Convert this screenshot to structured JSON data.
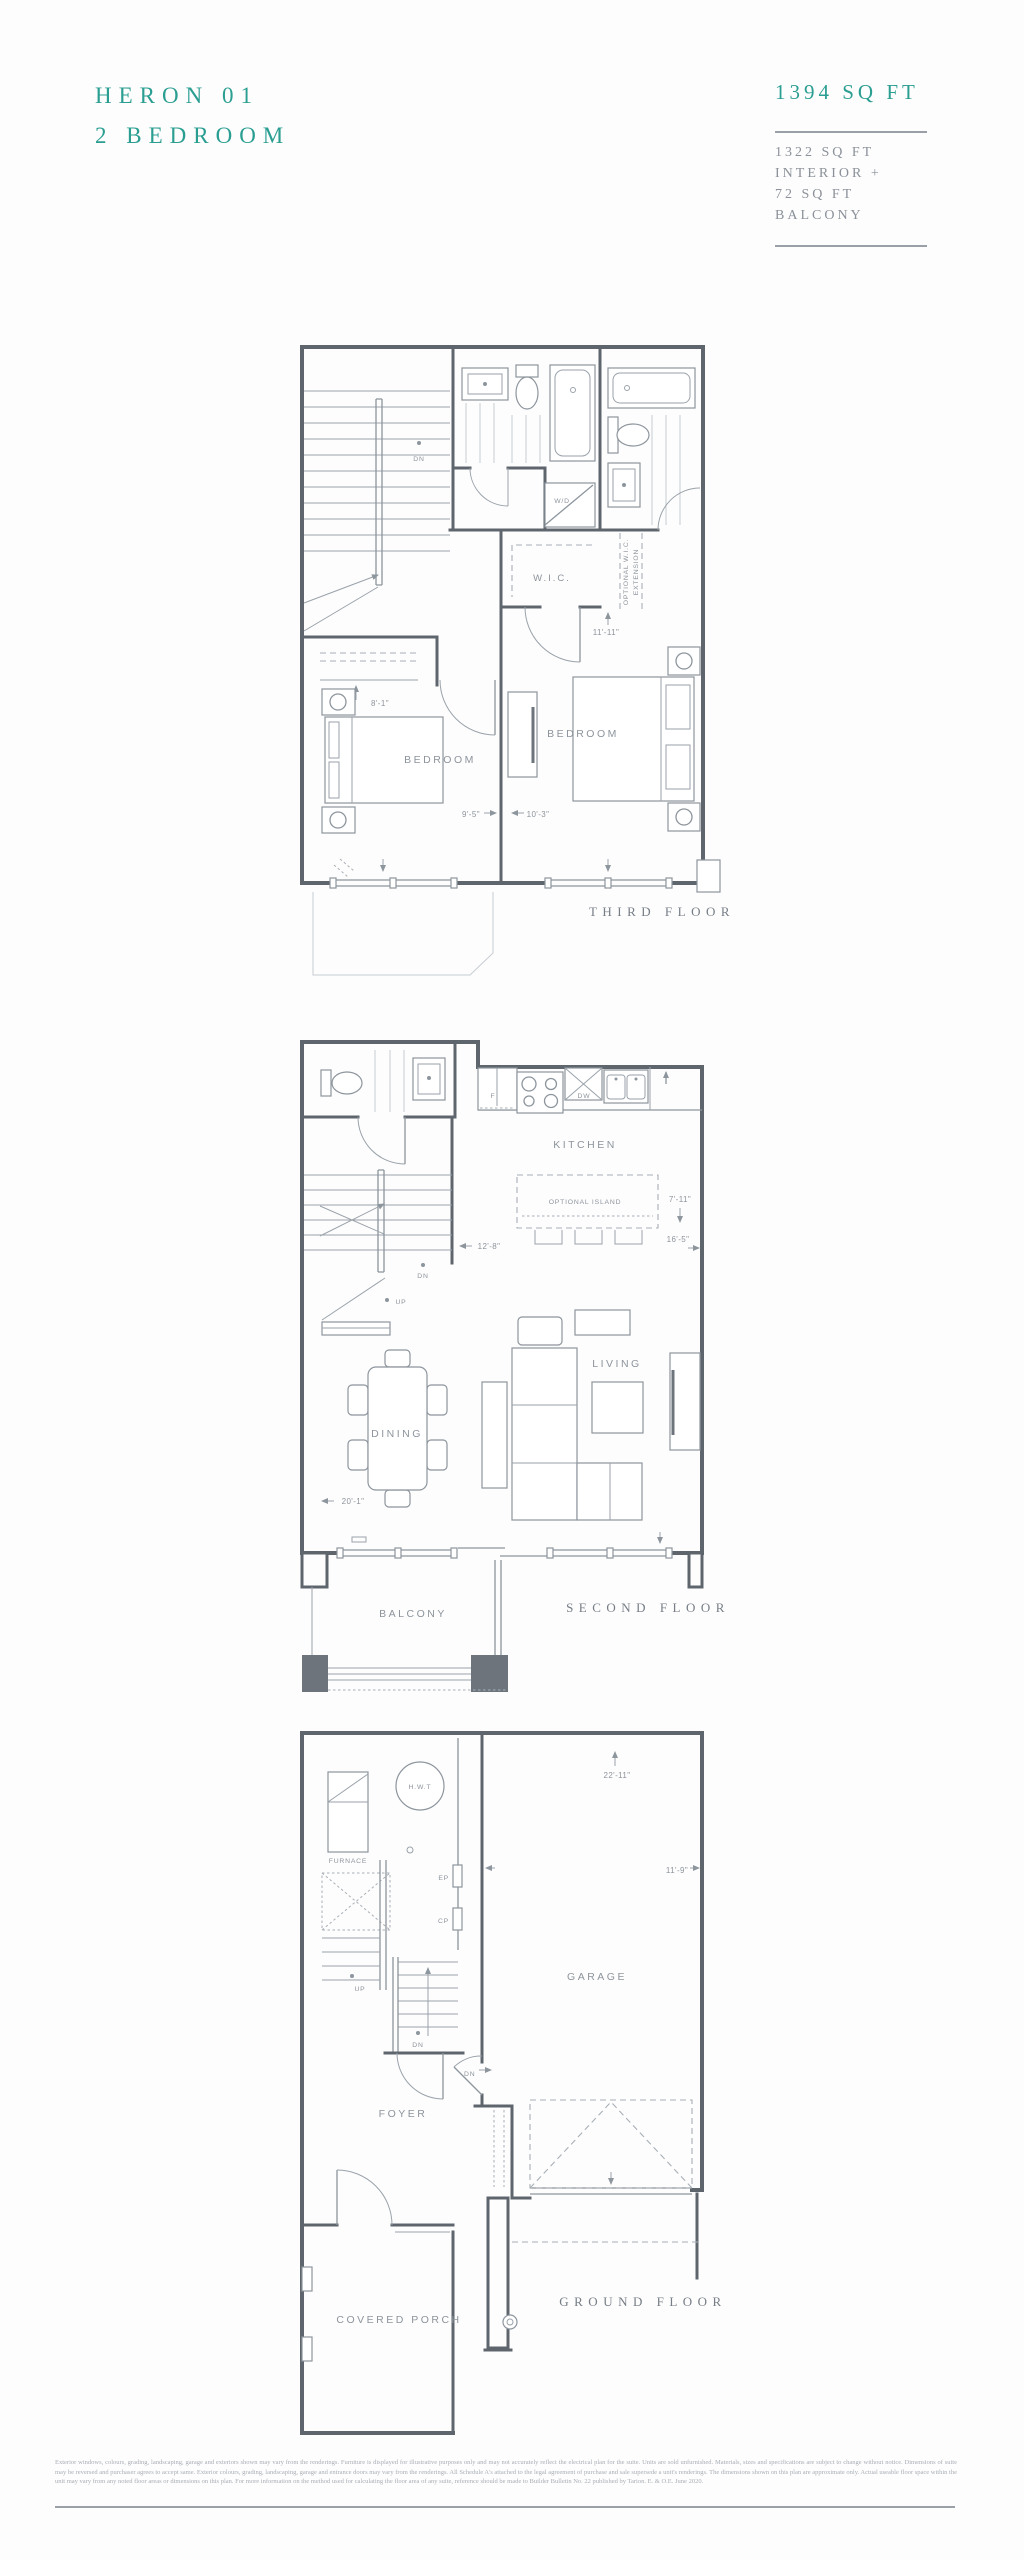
{
  "header": {
    "plan_name": "HERON 01",
    "plan_type": "2 BEDROOM",
    "total_area": "1394 SQ FT",
    "area_lines": [
      "1322 SQ FT",
      "INTERIOR +",
      "72 SQ FT",
      "BALCONY"
    ]
  },
  "floors": {
    "third": {
      "floor_label": "THIRD FLOOR",
      "labels": {
        "dn": "DN",
        "wd": "W/D",
        "wic": "W.I.C.",
        "optional_wic_1": "OPTIONAL W.I.C.",
        "optional_wic_2": "EXTENSION",
        "bedroom_left": "BEDROOM",
        "bedroom_right": "BEDROOM"
      },
      "dims": {
        "wic": "11'-11\"",
        "closet": "8'-1\"",
        "bedroom_left": "9'-5\"",
        "bedroom_right": "10'-3\""
      }
    },
    "second": {
      "floor_label": "SECOND FLOOR",
      "labels": {
        "kitchen": "KITCHEN",
        "optional_island": "OPTIONAL ISLAND",
        "fridge": "F",
        "dishwasher": "DW",
        "dn": "DN",
        "up": "UP",
        "dining": "DINING",
        "living": "LIVING",
        "balcony": "BALCONY"
      },
      "dims": {
        "stair": "12'-8\"",
        "island": "7'-11\"",
        "kitchen_width": "16'-5\"",
        "main_width": "20'-1\""
      }
    },
    "ground": {
      "floor_label": "GROUND FLOOR",
      "labels": {
        "hwt": "H.W.T",
        "furnace": "FURNACE",
        "ep": "EP",
        "cp": "CP",
        "up": "UP",
        "dn_stair": "DN",
        "dn_garage": "DN",
        "garage": "GARAGE",
        "foyer": "FOYER",
        "covered_porch": "COVERED PORCH"
      },
      "dims": {
        "garage_width": "22'-11\"",
        "garage_depth": "11'-9\""
      }
    }
  },
  "footer": {
    "disclaimer": "Exterior windows, colours, grading, landscaping, garage and exteriors shown may vary from the renderings. Furniture is displayed for illustrative purposes only and may not accurately reflect the electrical plan for the suite. Units are sold unfurnished. Materials, sizes and specifications are subject to change without notice. Dimensions of suite may be reversed and purchaser agrees to accept same. Exterior colours, grading, landscaping, garage and entrance doors may vary from the renderings. All Schedule A's attached to the legal agreement of purchase and sale supersede a unit's renderings. The dimensions shown on this plan are approximate only. Actual useable floor space within the unit may vary from any noted floor areas or dimensions on this plan. For more information on the method used for calculating the floor area of any suite, reference should be made to Builder Bulletin No. 22 published by Tarion. E. & O.E. June 2020."
  },
  "colors": {
    "accent_teal": "#2b9e92",
    "text_gray": "#8b919a",
    "wall_gray": "#5e656d",
    "line_gray": "#9aa2aa"
  }
}
